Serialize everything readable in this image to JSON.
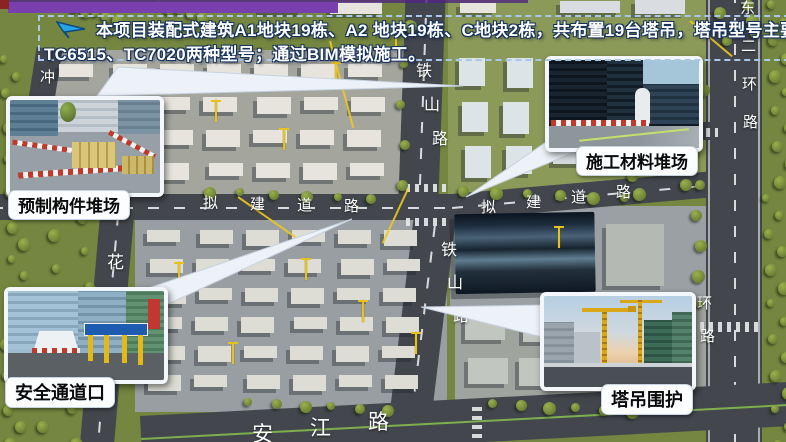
{
  "slide": {
    "accent": {
      "top_bar_color": "#7a3fae",
      "corner_square_color": "#8b2320"
    },
    "banner": {
      "icon": "paper-plane-icon",
      "line1": "本项目装配式建筑A1地块19栋、A2 地块19栋、C地块2栋，共布置19台塔吊，塔吊型号主要使用",
      "line2": "TC6515、TC7020两种型号；通过BIM模拟施工。",
      "border_color": "#a9c7e8",
      "text_color": "#ffffff"
    }
  },
  "callouts": [
    {
      "id": "precast-yard",
      "label": "预制构件堆场",
      "position": "top-left"
    },
    {
      "id": "material-yard",
      "label": "施工材料堆场",
      "position": "top-right"
    },
    {
      "id": "safety-gate",
      "label": "安全通道口",
      "position": "bottom-left"
    },
    {
      "id": "crane-fence",
      "label": "塔吊围护",
      "position": "bottom-right"
    }
  ],
  "map": {
    "road_labels": [
      {
        "text": "铁山路",
        "orientation": "vertical",
        "x": 416,
        "y": 64,
        "step": 34,
        "drift": 8,
        "size": 16
      },
      {
        "text": "铁山路",
        "orientation": "vertical",
        "x": 441,
        "y": 243,
        "step": 33,
        "drift": 6,
        "size": 16
      },
      {
        "text": "拟建道路",
        "orientation": "horizontal",
        "x": 203,
        "y": 196,
        "step": 47,
        "drift": 1,
        "size": 15
      },
      {
        "text": "拟建道路",
        "orientation": "horizontal",
        "x": 481,
        "y": 200,
        "step": 45,
        "drift": -5,
        "size": 15
      },
      {
        "text": "东二环路",
        "orientation": "vertical",
        "x": 740,
        "y": 1,
        "step": 38,
        "drift": 1,
        "size": 15
      },
      {
        "text": "环路",
        "orientation": "vertical",
        "x": 697,
        "y": 296,
        "step": 33,
        "drift": 3,
        "size": 15
      },
      {
        "text": "花",
        "orientation": "vertical",
        "x": 107,
        "y": 254,
        "step": 0,
        "drift": 0,
        "size": 17
      },
      {
        "text": "冲",
        "orientation": "vertical",
        "x": 40,
        "y": 70,
        "step": 0,
        "drift": 0,
        "size": 15
      },
      {
        "text": "安江路",
        "orientation": "horizontal",
        "x": 252,
        "y": 424,
        "step": 58,
        "drift": -6,
        "size": 21
      }
    ]
  }
}
